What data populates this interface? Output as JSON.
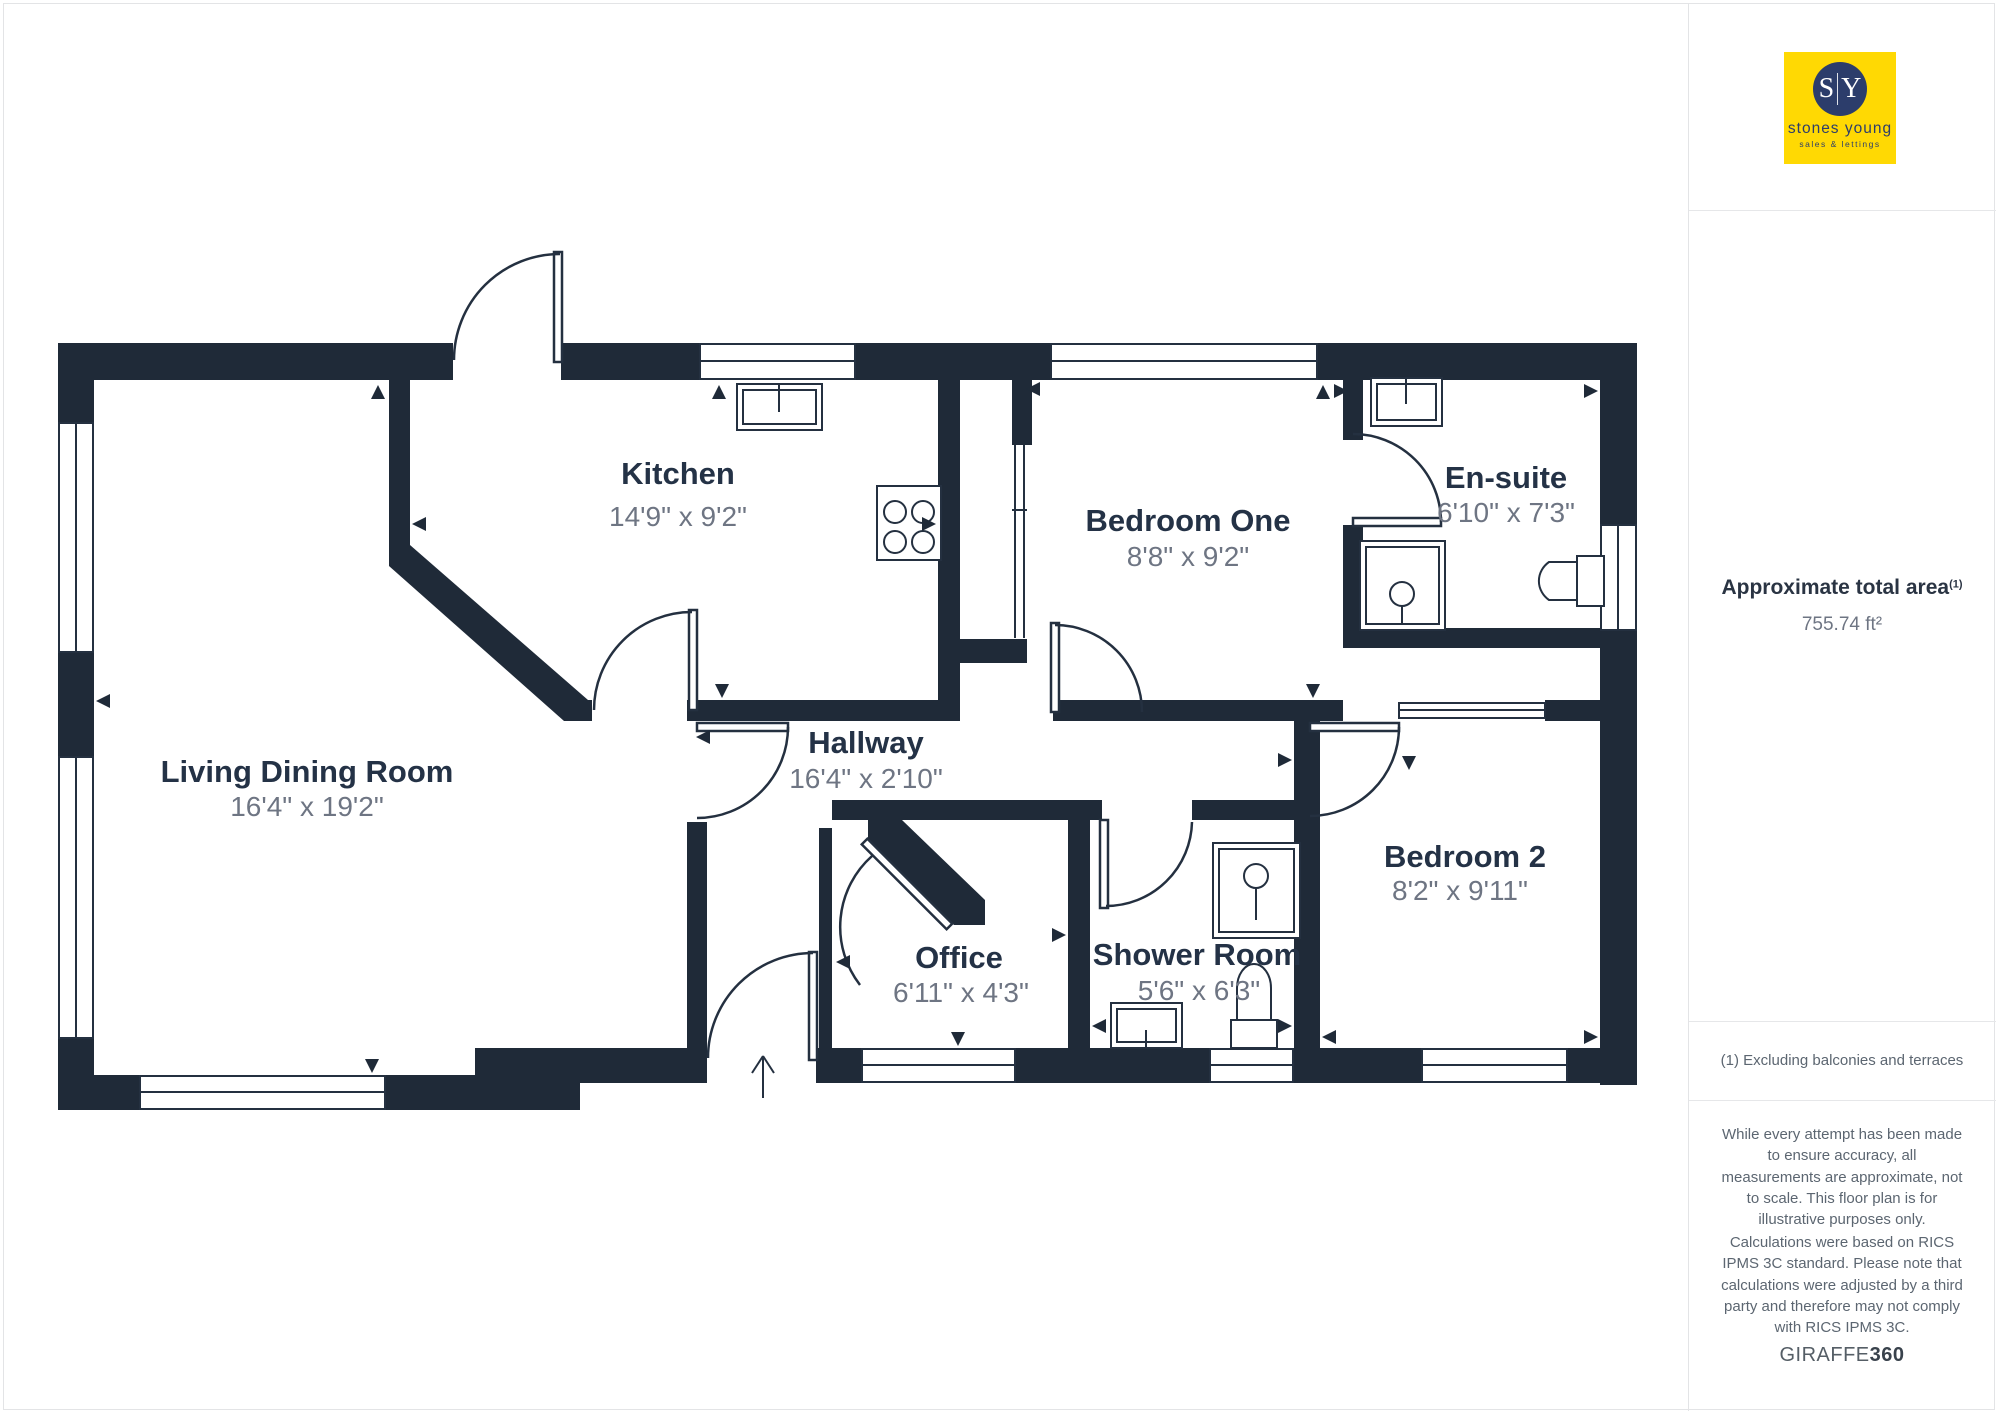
{
  "logo": {
    "sy_left": "S",
    "sy_right": "Y",
    "name": "stones young",
    "tagline": "sales & lettings",
    "bg_color": "#FFD903",
    "navy_color": "#2C3D6B"
  },
  "sidebar": {
    "area_label": "Approximate total area",
    "area_sup": "(1)",
    "area_value": "755.74 ft²",
    "footnote": "(1) Excluding balconies and terraces",
    "disclaimer1": "While every attempt has been made to ensure accuracy, all measurements are approximate, not to scale. This floor plan is for illustrative purposes only.",
    "disclaimer2": "Calculations were based on RICS IPMS 3C standard. Please note that calculations were adjusted by a third party and therefore may not comply with RICS IPMS 3C.",
    "brand": "GIRAFFE",
    "brand_bold": "360"
  },
  "rooms": [
    {
      "id": "living",
      "name": "Living Dining Room",
      "dims": "16'4\" x 19'2\""
    },
    {
      "id": "kitchen",
      "name": "Kitchen",
      "dims": "14'9\" x 9'2\""
    },
    {
      "id": "bedroom1",
      "name": "Bedroom One",
      "dims": "8'8\" x 9'2\""
    },
    {
      "id": "ensuite",
      "name": "En-suite",
      "dims": "6'10\" x 7'3\""
    },
    {
      "id": "hallway",
      "name": "Hallway",
      "dims": "16'4\" x 2'10\""
    },
    {
      "id": "office",
      "name": "Office",
      "dims": "6'11\" x 4'3\""
    },
    {
      "id": "shower",
      "name": "Shower Room",
      "dims": "5'6\" x 6'3\""
    },
    {
      "id": "bedroom2",
      "name": "Bedroom 2",
      "dims": "8'2\" x 9'11\""
    }
  ],
  "colors": {
    "wall": "#1F2A38",
    "room_text": "#243246",
    "dim_text": "#6E7583",
    "divider": "#E3E4E6"
  }
}
